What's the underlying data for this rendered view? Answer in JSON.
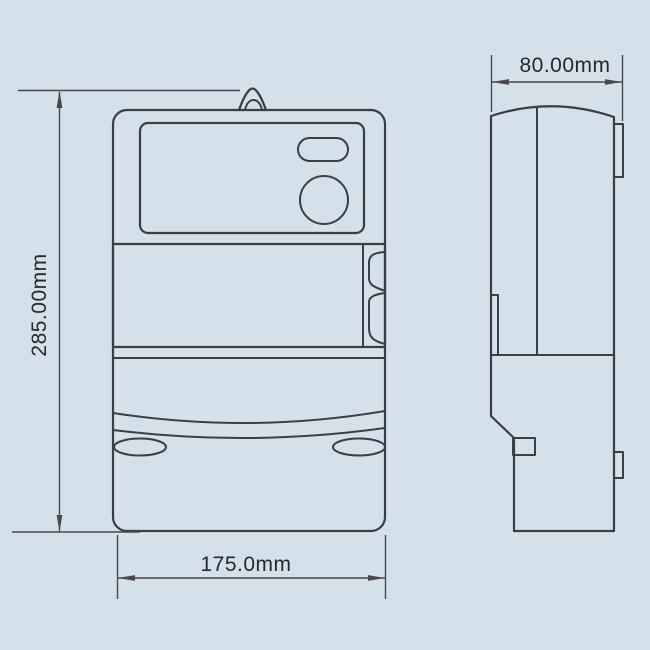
{
  "colors": {
    "background": "#d4e0ea",
    "line": "#3b3f43",
    "dim": "#46494d",
    "text": "#26292c"
  },
  "dimensions": {
    "height": {
      "label": "285.00mm"
    },
    "width": {
      "label": "175.0mm"
    },
    "depth": {
      "label": "80.00mm"
    }
  }
}
